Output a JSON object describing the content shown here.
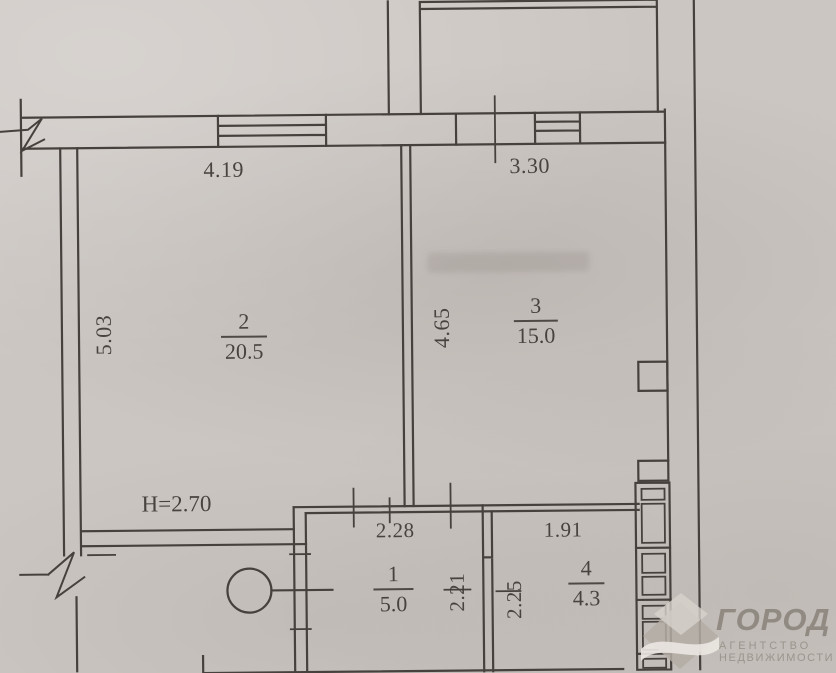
{
  "rooms": [
    {
      "number": "2",
      "area": "20.5"
    },
    {
      "number": "3",
      "area": "15.0"
    },
    {
      "number": "1",
      "area": "5.0"
    },
    {
      "number": "4",
      "area": "4.3"
    }
  ],
  "dimensions": {
    "room2_width": "4.19",
    "room3_width": "3.30",
    "room2_height": "5.03",
    "room3_height": "4.65",
    "room1_width": "2.28",
    "room4_width": "1.91",
    "room1_height": "2.21",
    "room4_height": "2.25",
    "ceiling_height": "H=2.70"
  },
  "watermark": {
    "brand": "ГОРОД",
    "tagline_line1": "АГЕНТСТВО",
    "tagline_line2": "НЕДВИЖИМОСТИ"
  },
  "colors": {
    "paper": "#ccc6c2",
    "ink": "#46413c",
    "watermark_text": "#8a847b",
    "watermark_diamond": "#b3ada5"
  }
}
